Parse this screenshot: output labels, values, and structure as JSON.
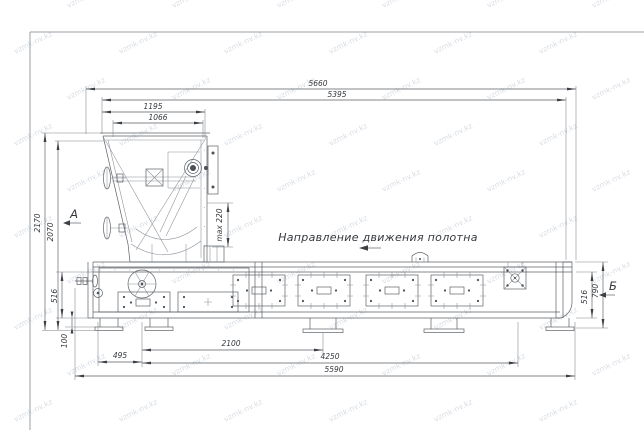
{
  "watermark": {
    "text": "vzmk-nv.kz"
  },
  "notes": {
    "direction": "Направление движения полотна"
  },
  "views": {
    "a": "А",
    "b": "Б"
  },
  "dims": {
    "d5660": "5660",
    "d5395": "5395",
    "d1195": "1195",
    "d1066": "1066",
    "d2170": "2170",
    "d2070": "2070",
    "dmax220": "max 220",
    "d516_left": "516",
    "d100": "100",
    "d495": "495",
    "d2100": "2100",
    "d4250": "4250",
    "d5590": "5590",
    "d516_right": "516",
    "d790": "790"
  },
  "colors": {
    "line": "#5c6167",
    "dimension": "#565b61",
    "text": "#34383d",
    "watermark": "#b3bdca",
    "frame": "#9aa0a6",
    "background": "#ffffff"
  }
}
